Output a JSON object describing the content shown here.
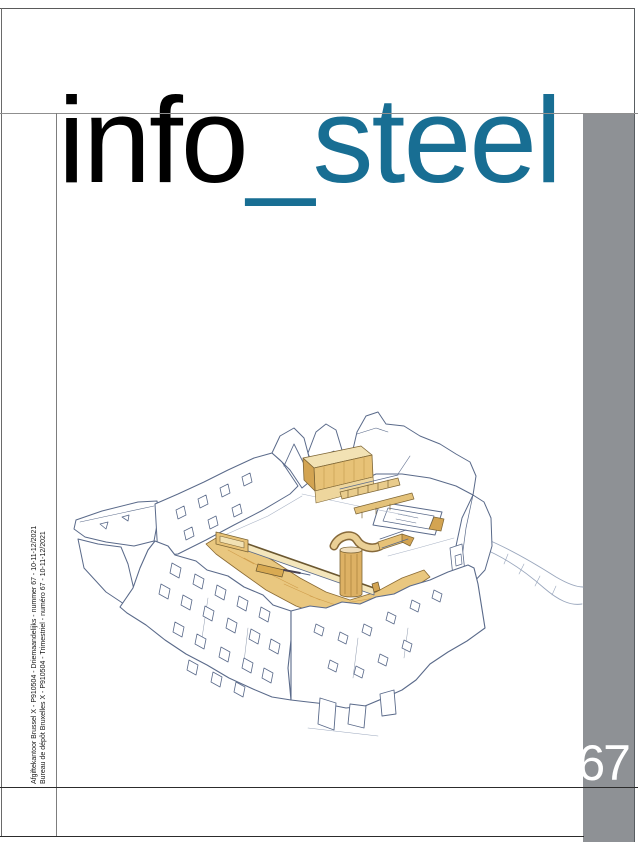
{
  "masthead": {
    "word_black": "info",
    "word_accent": "_steel"
  },
  "issue": {
    "number": "67"
  },
  "imprint": {
    "line1": "Afgiftekantoor Brussel X - P910504 - Driemaandelijks - nummer 67 - 10-11-12/2021",
    "line2": "Bureau de dépôt Bruxelles X - P910504 - Trimestriel - numéro 67 - 10-11-12/2021"
  },
  "colors": {
    "accent_teal": "#186e93",
    "sidebar_gray": "#8e9195",
    "issue_number_white": "#ffffff",
    "sketch_ink_blue": "#5a6a8a",
    "sketch_tan_light": "#f2e2b4",
    "sketch_tan": "#e7c277",
    "sketch_tan_dark": "#d3a452"
  },
  "illustration": {
    "name": "castle-ruin-courtyard-sketch",
    "media": "hand-drawn ink and watercolor, ruined walls with timber insertions"
  }
}
